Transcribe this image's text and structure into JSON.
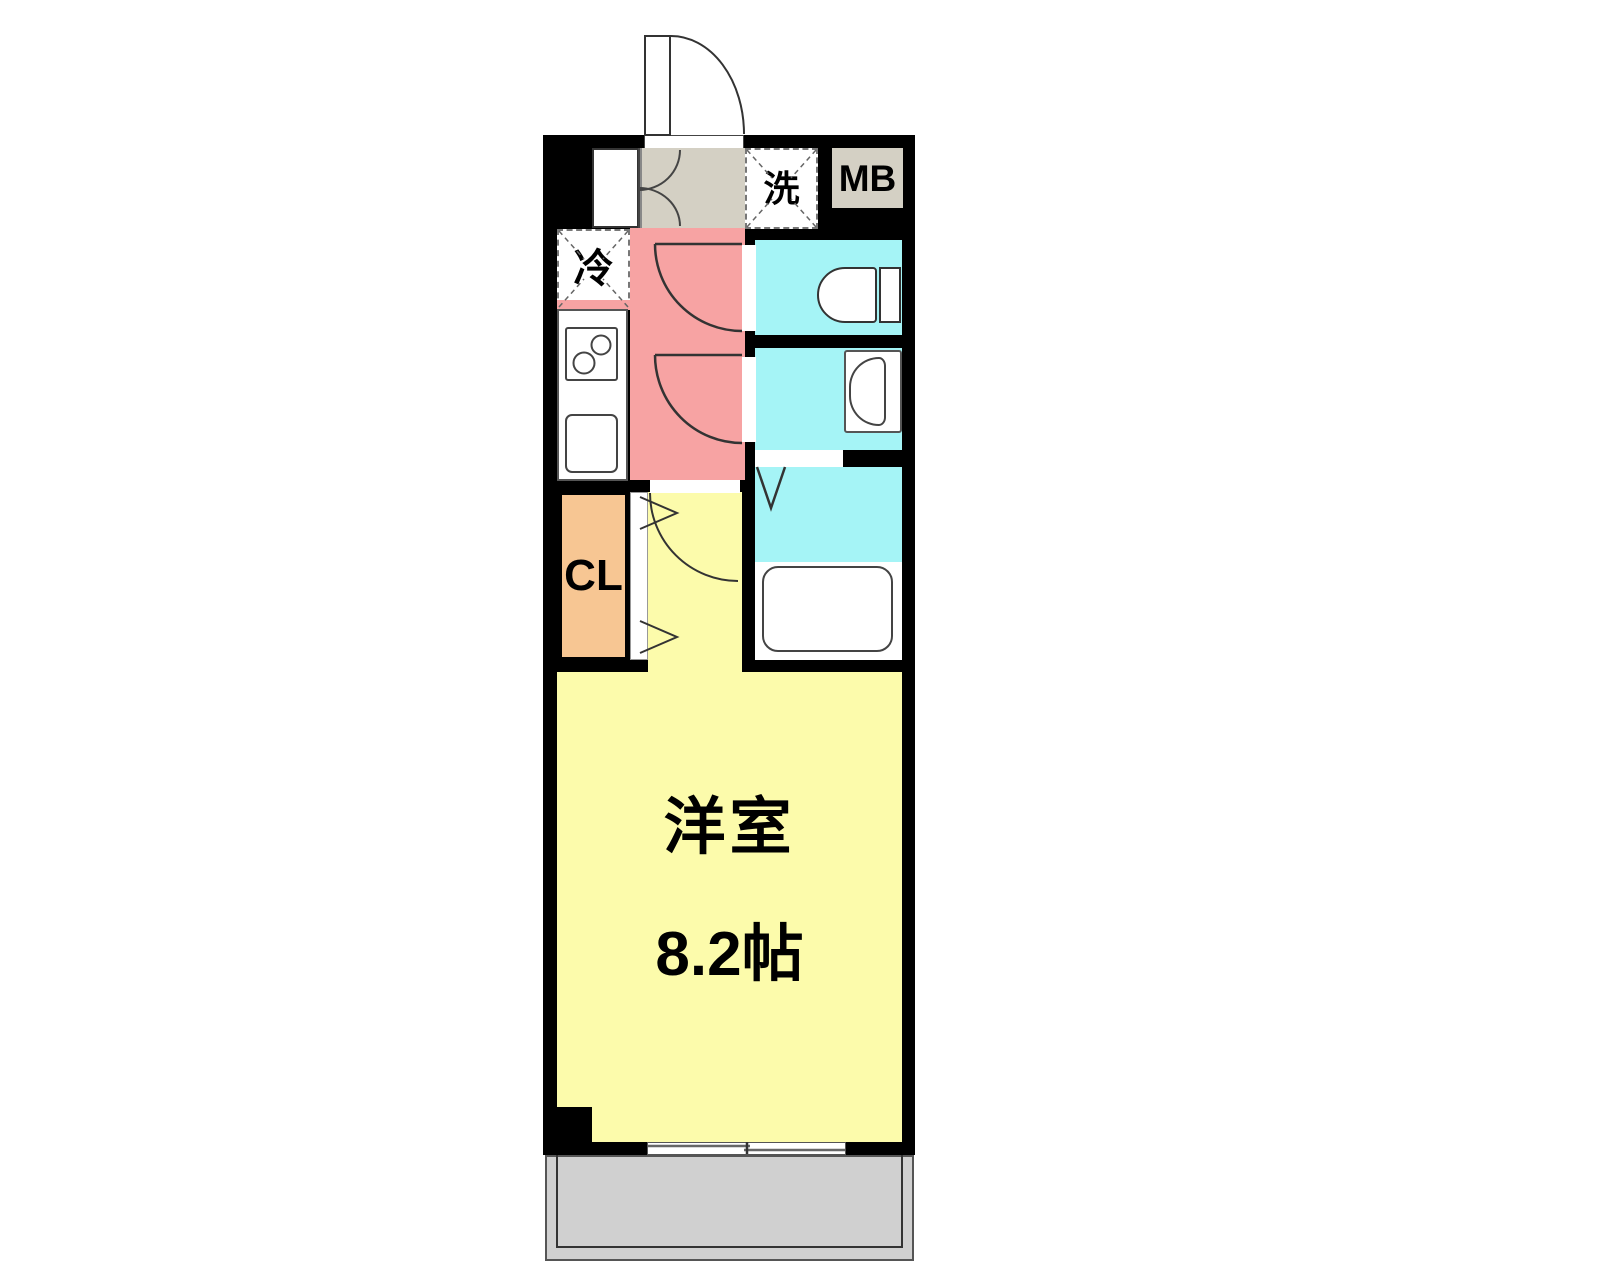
{
  "floor_plan": {
    "labels": {
      "washer": "洗",
      "meter_box": "MB",
      "refrigerator": "冷",
      "closet": "CL",
      "main_room": "洋室",
      "main_room_size": "8.2帖"
    },
    "colors": {
      "wall": "#000000",
      "hall_kitchen": "#F7A3A3",
      "wet_area": "#A5F4F6",
      "main_room": "#FCFBAB",
      "closet": "#F7C693",
      "entrance": "#D4D0C4",
      "meter_box": "#D4D0C4",
      "balcony": "#D0D0D0",
      "fixture": "#FFFFFF"
    }
  }
}
